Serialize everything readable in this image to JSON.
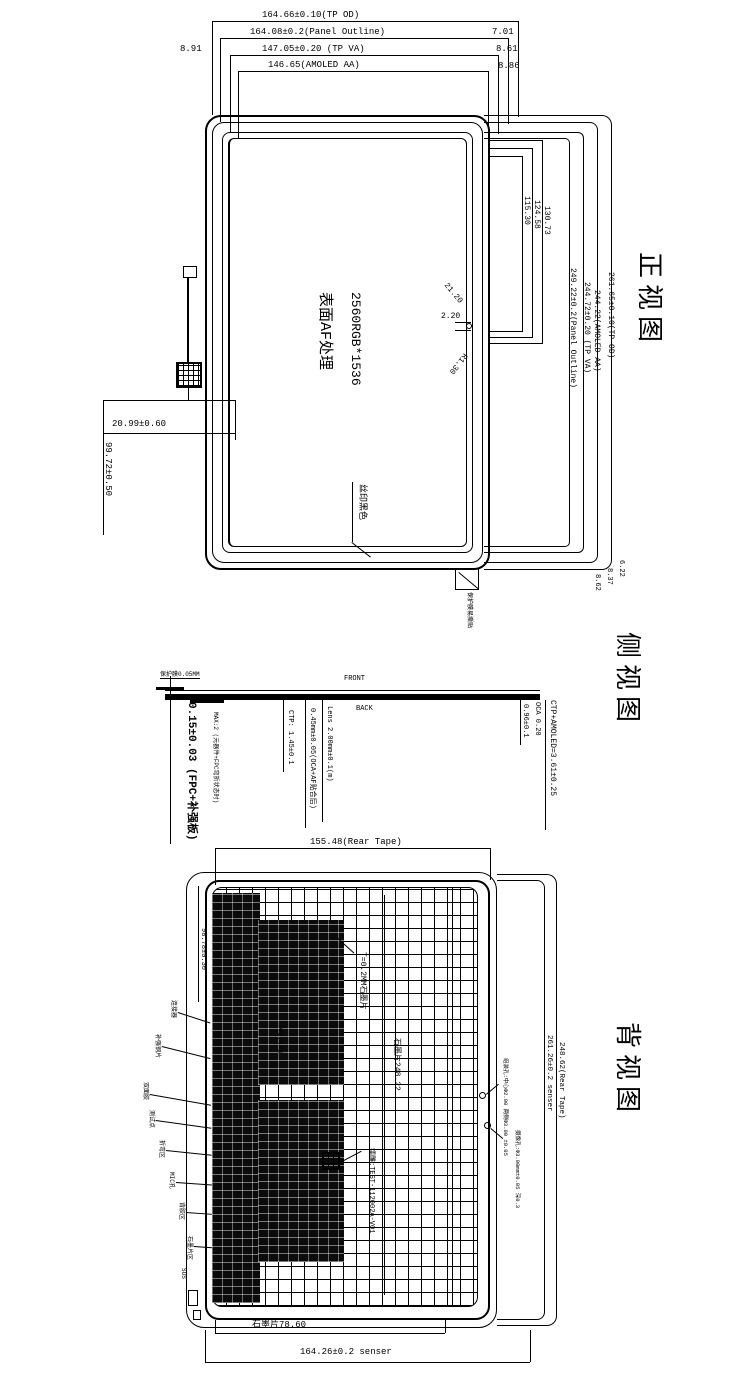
{
  "front": {
    "title": "正视图",
    "top_dims": [
      "164.66±0.10(TP OD)",
      "164.08±0.2(Panel Outline)",
      "147.05±0.20 (TP VA)",
      "146.65(AMOLED AA)"
    ],
    "left_offset": "8.91",
    "right_offsets": [
      "7.01",
      "8.61",
      "8.86"
    ],
    "right_dims": [
      "249.22±0.2(Panel Outline)",
      "244.72±0.20 (TP VA)",
      "244.22(AMOLED AA)",
      "261.65±0.10(TP OD)"
    ],
    "mid_dims": [
      "115.30",
      "124.58",
      "130.73"
    ],
    "hole": {
      "diag_top": "21.20",
      "width": "2.20",
      "diag_bottom": "R1.30"
    },
    "bottom_right_offsets": [
      "8.62",
      "8.37",
      "6.22"
    ],
    "fpc_dim_h": "20.99±0.60",
    "fpc_dim_v": "99.72±0.50",
    "silk_label": "丝印黑色",
    "tab_label": "保护膜易撕贴",
    "center_resolution": "2560RGB*1536",
    "center_surface": "表面AF处理"
  },
  "side": {
    "title": "侧视图",
    "front_label": "FRONT",
    "back_label": "BACK",
    "film_label": "保护膜0.05MM",
    "thickness_main": "0.15±0.03 (FPC+补强板)",
    "max_label": "MAX:2 (元器件+FPC弯折状态时)",
    "ctp_label": "CTP: 1.45±0.1",
    "oca_label": "0.45mm±0.05(OCA+AF贴合后)",
    "lens_label": "Lens 2.00mm±0.1(m)",
    "right_small": "0.96±0.1",
    "oca2_label": "OCA 0.20",
    "stack_label": "CTP+AMOLED=3.61±0.25"
  },
  "rear": {
    "title": "背视图",
    "top_dim": "155.48(Rear Tape)",
    "left_dim": "98.78±0.30",
    "graphite_note": "T=0.2MM石墨片",
    "graphite_dim": "石墨片248.22",
    "holes_note": "Φ1.4×8",
    "laser_label": "镭雕:TEST-112002A-V01",
    "right_dims": [
      "261.26±0.2 senser",
      "248.62(Rear Tape)"
    ],
    "hole_callouts": [
      "组装孔:中心Φ2.00 两侧Φ3.00 ±0.05",
      "摄像孔:Φ3.00mm±0.05 深0.3"
    ],
    "left_callouts": [
      "连接器",
      "补强钢片",
      "双面胶",
      "测试点",
      "折弯区",
      "MIC孔",
      "背胶区",
      "石墨片区"
    ],
    "bottom_graphite": "石墨片78.60",
    "bottom_dim": "164.26±0.2 senser",
    "sus_label": "SUS"
  }
}
